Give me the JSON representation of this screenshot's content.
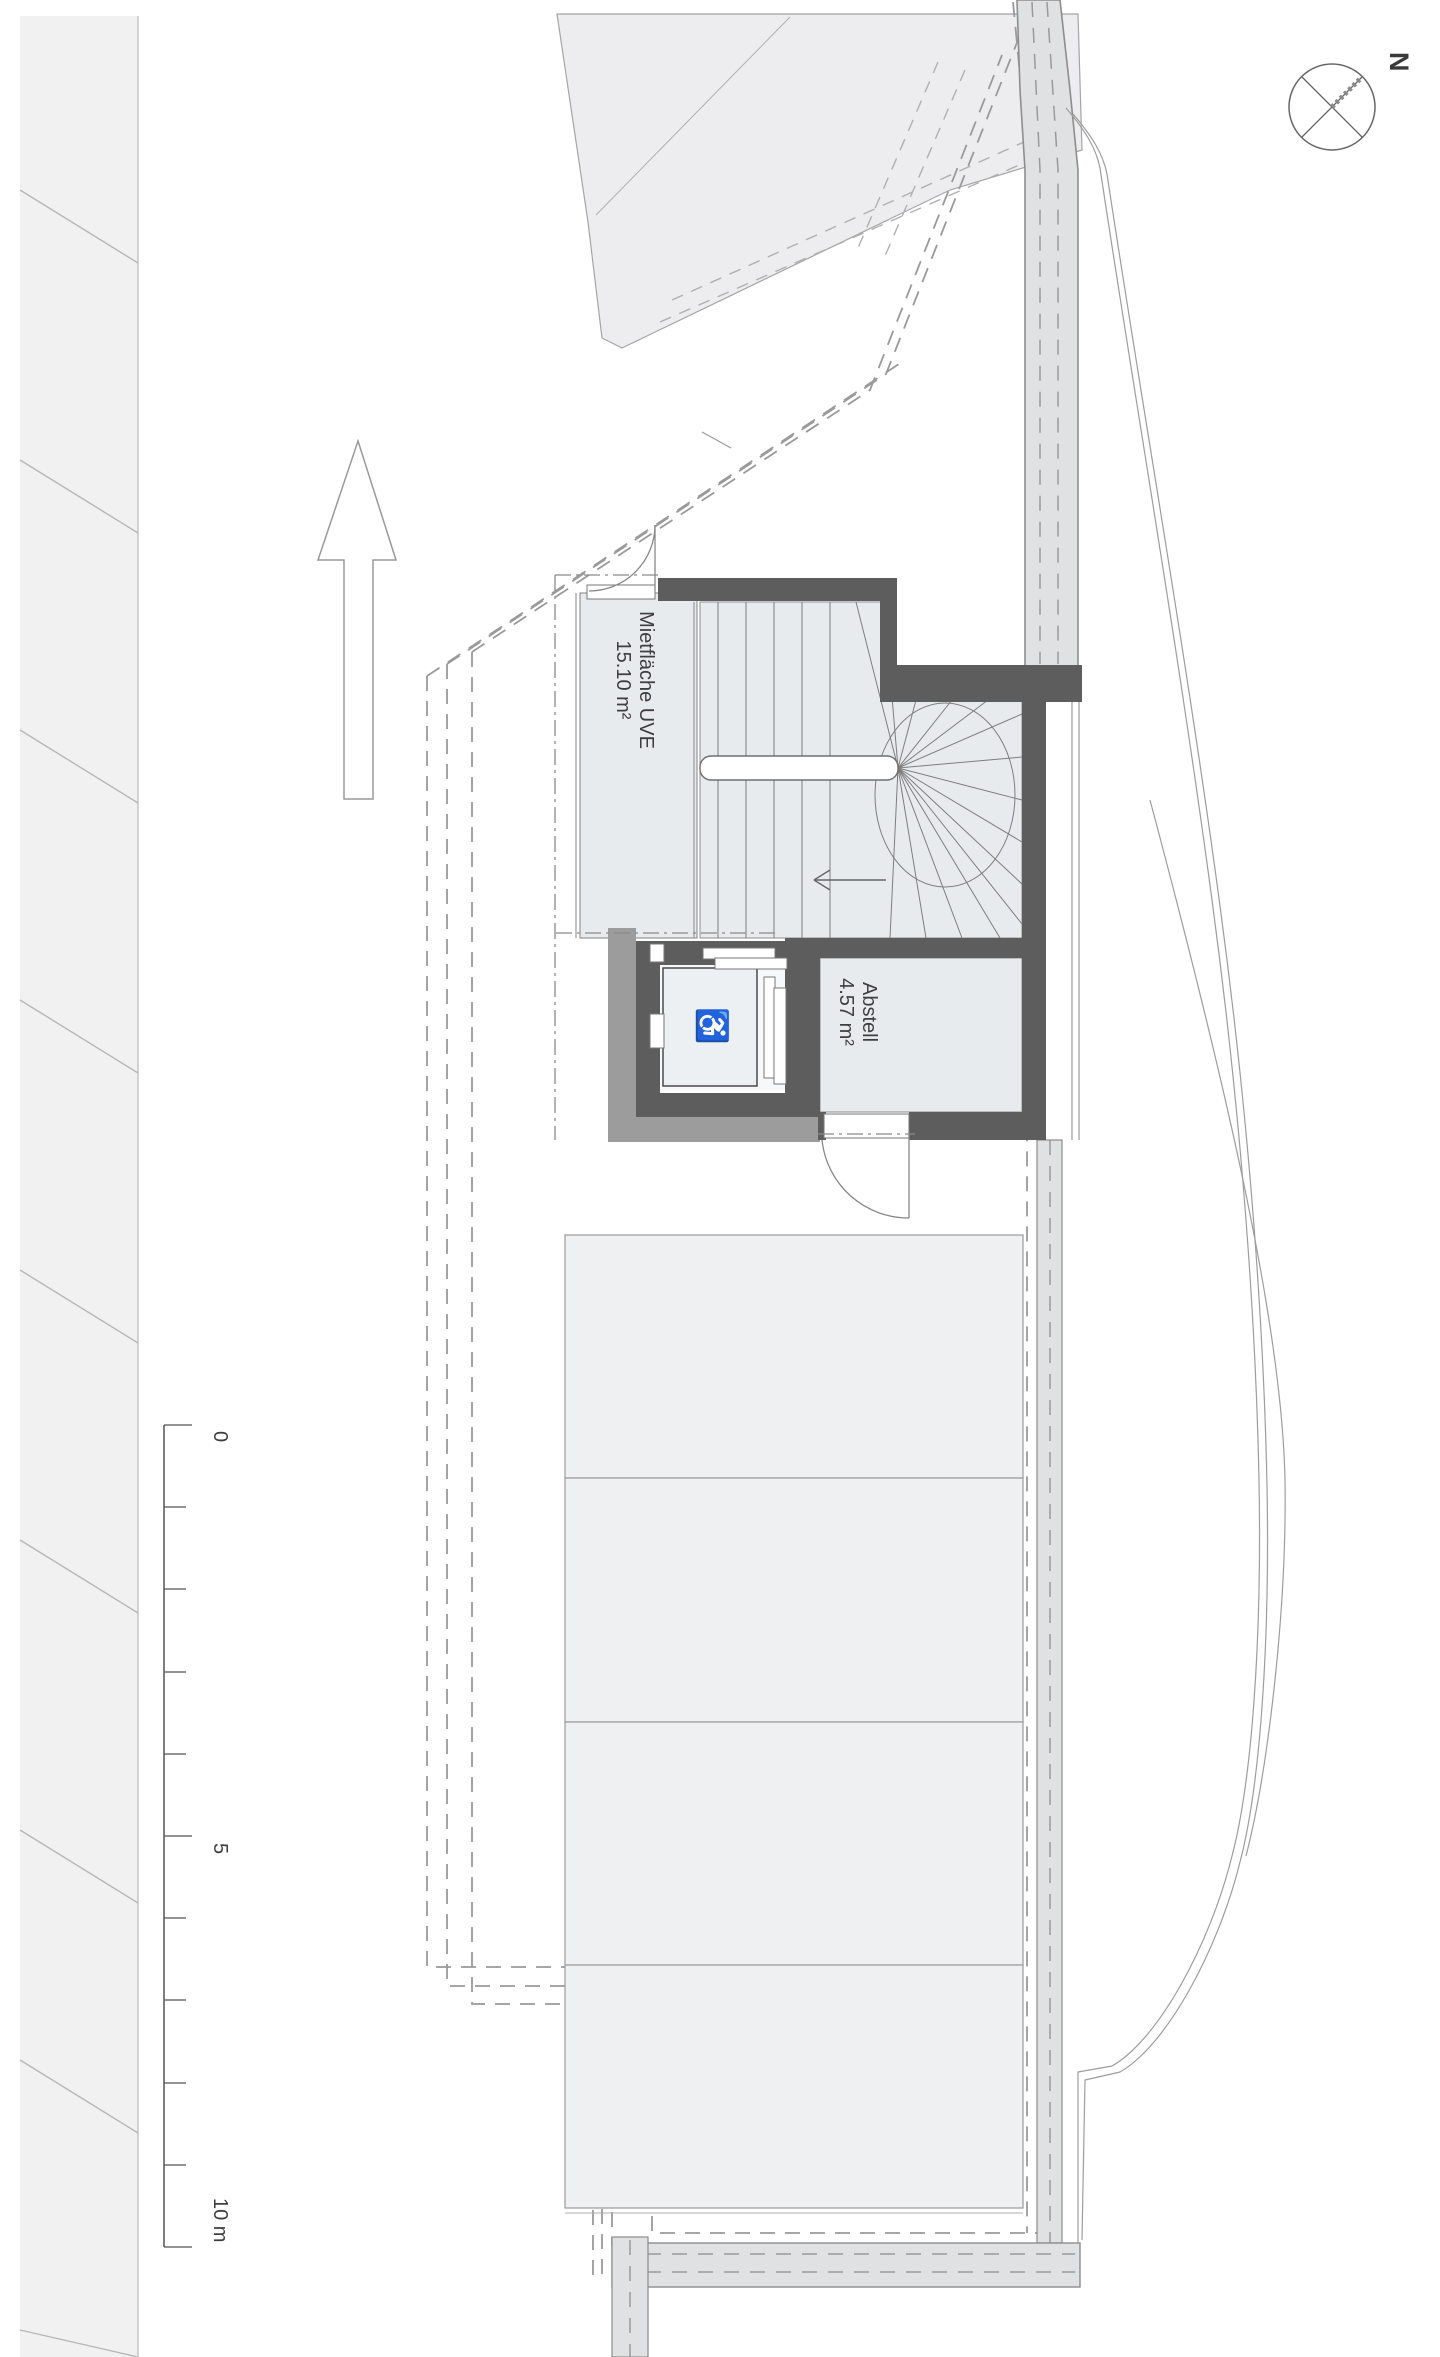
{
  "drawing": {
    "compass": {
      "label": "N"
    },
    "rooms": [
      {
        "name": "Mietfläche UVE",
        "area": "15.10 m²"
      },
      {
        "name": "Abstell",
        "area": "4.57 m²"
      }
    ],
    "scale_bar": {
      "labels": [
        "0",
        "5",
        "10 m"
      ]
    },
    "icons": {
      "wheelchair": "♿"
    },
    "colors": {
      "wall_dark": "#5d5d5d",
      "wall_medium": "#9c9c9c",
      "room_fill": "#e8ebee",
      "parcel_fill": "#ededef",
      "road_fill": "#dfe1e3",
      "parking_fill": "#eff0f1",
      "lift_car_fill": "#edf0f2",
      "text": "#3e3e3e"
    }
  }
}
